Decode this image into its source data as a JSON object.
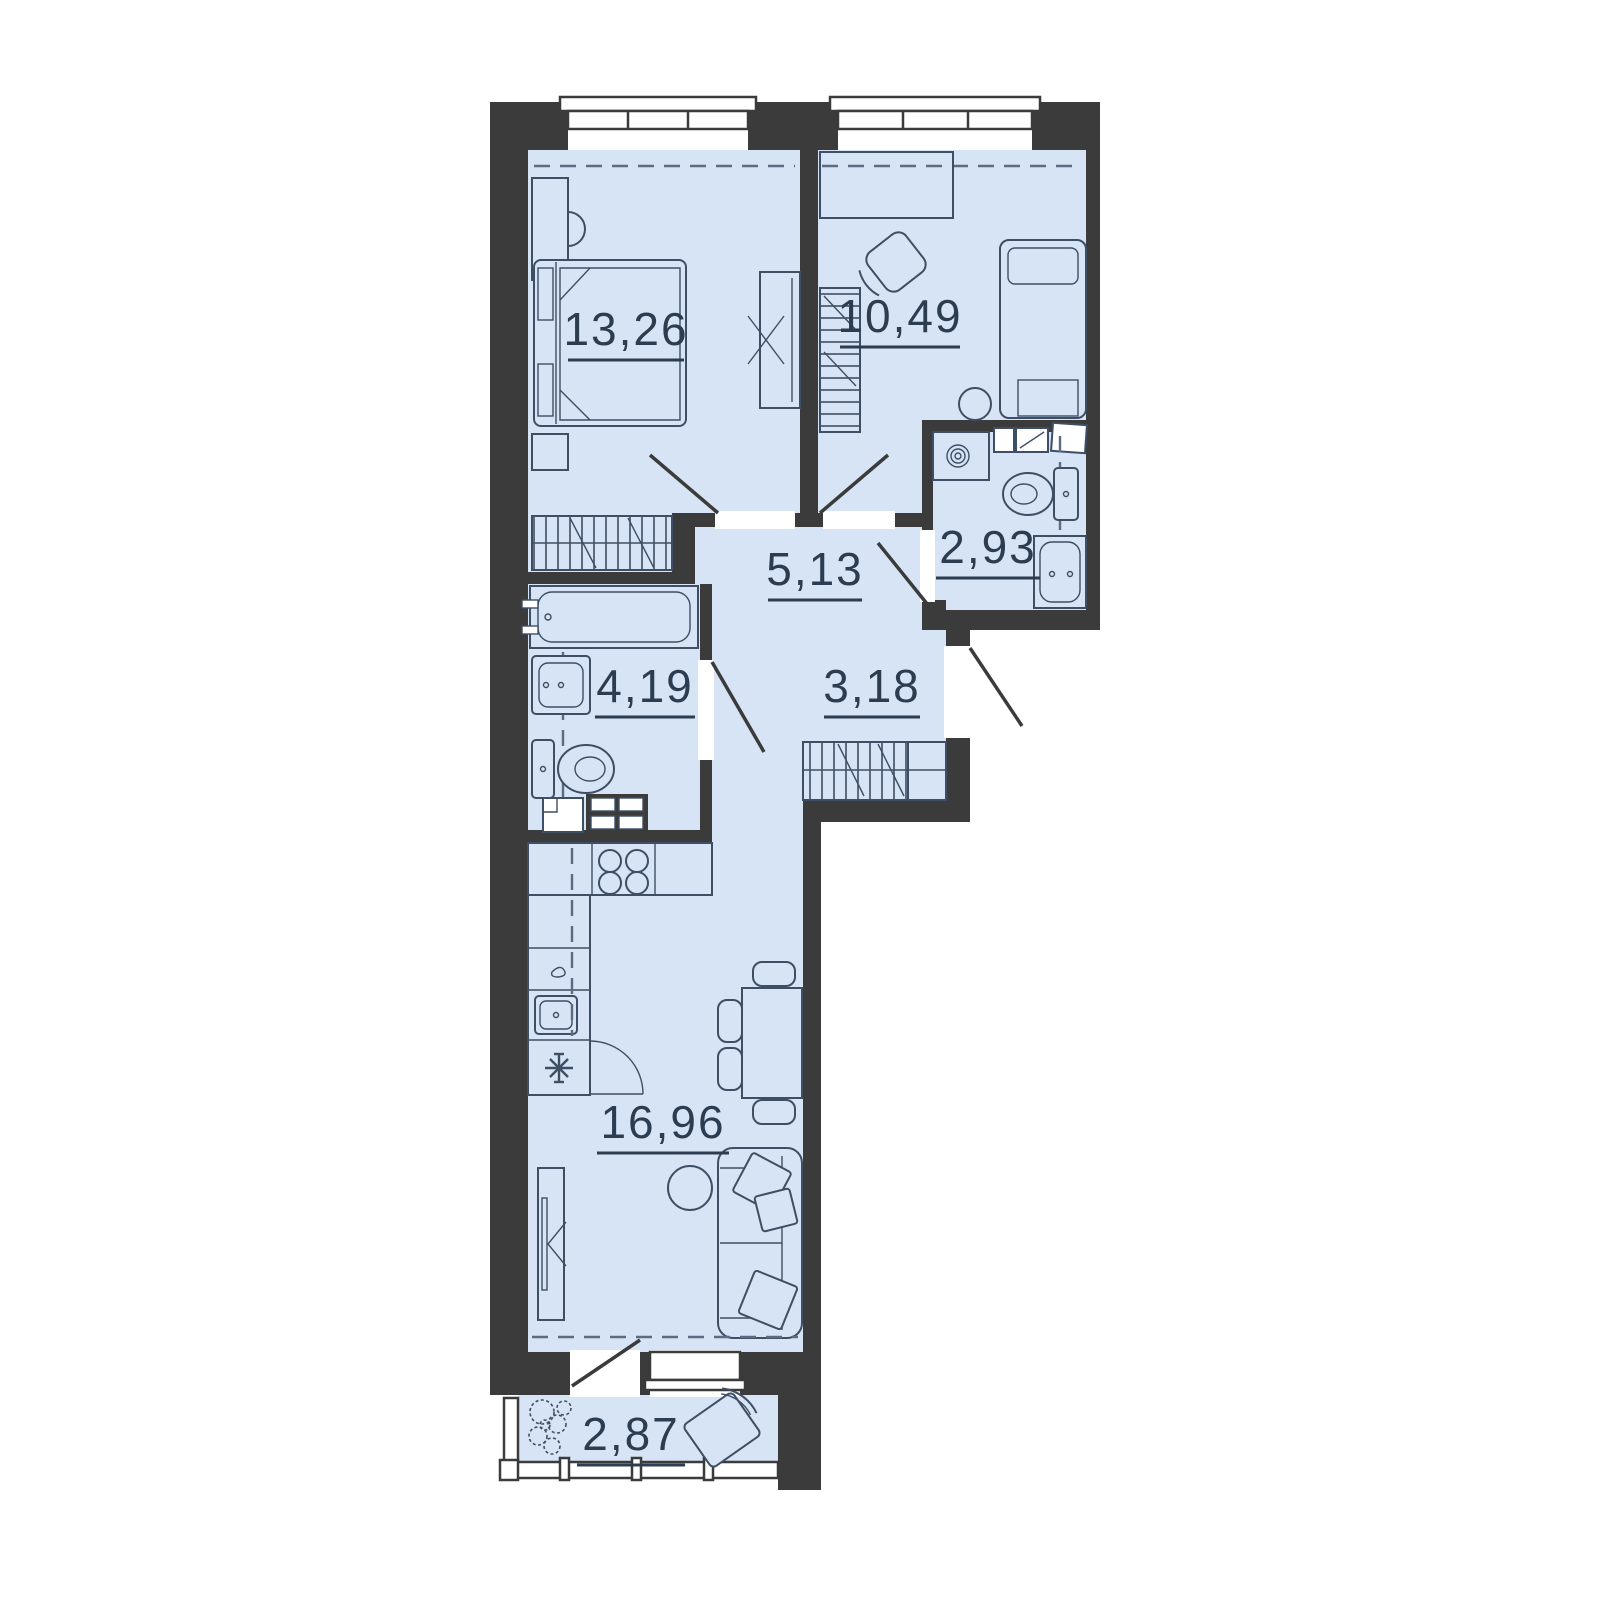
{
  "plan": {
    "type": "apartment-floor-plan",
    "units": "m2",
    "rooms": [
      {
        "name": "bedroom-1",
        "area": "13,26"
      },
      {
        "name": "bedroom-2",
        "area": "10,49"
      },
      {
        "name": "bathroom-guest",
        "area": "2,93"
      },
      {
        "name": "hallway",
        "area": "5,13"
      },
      {
        "name": "bathroom-main",
        "area": "4,19"
      },
      {
        "name": "corridor",
        "area": "3,18"
      },
      {
        "name": "kitchen-living",
        "area": "16,96"
      },
      {
        "name": "balcony",
        "area": "2,87"
      }
    ],
    "fixtures": [
      "double-bed",
      "desk",
      "chair",
      "wardrobe",
      "mirror-wardrobe",
      "single-bed",
      "stool",
      "washing-machine",
      "toilet",
      "bathtub",
      "sink",
      "stove-4-burner",
      "fridge",
      "dishwasher",
      "dining-table",
      "chairs",
      "sofa",
      "pillows",
      "coffee-table",
      "tv-console",
      "plant",
      "lounge-chair"
    ],
    "colors": {
      "wall": "#3b3b3b",
      "room_fill": "#d6e4f6",
      "furniture_line": "#3e4e64",
      "label": "#2d3d51",
      "background": "#ffffff",
      "dashed_line": "#5a6b82"
    }
  }
}
